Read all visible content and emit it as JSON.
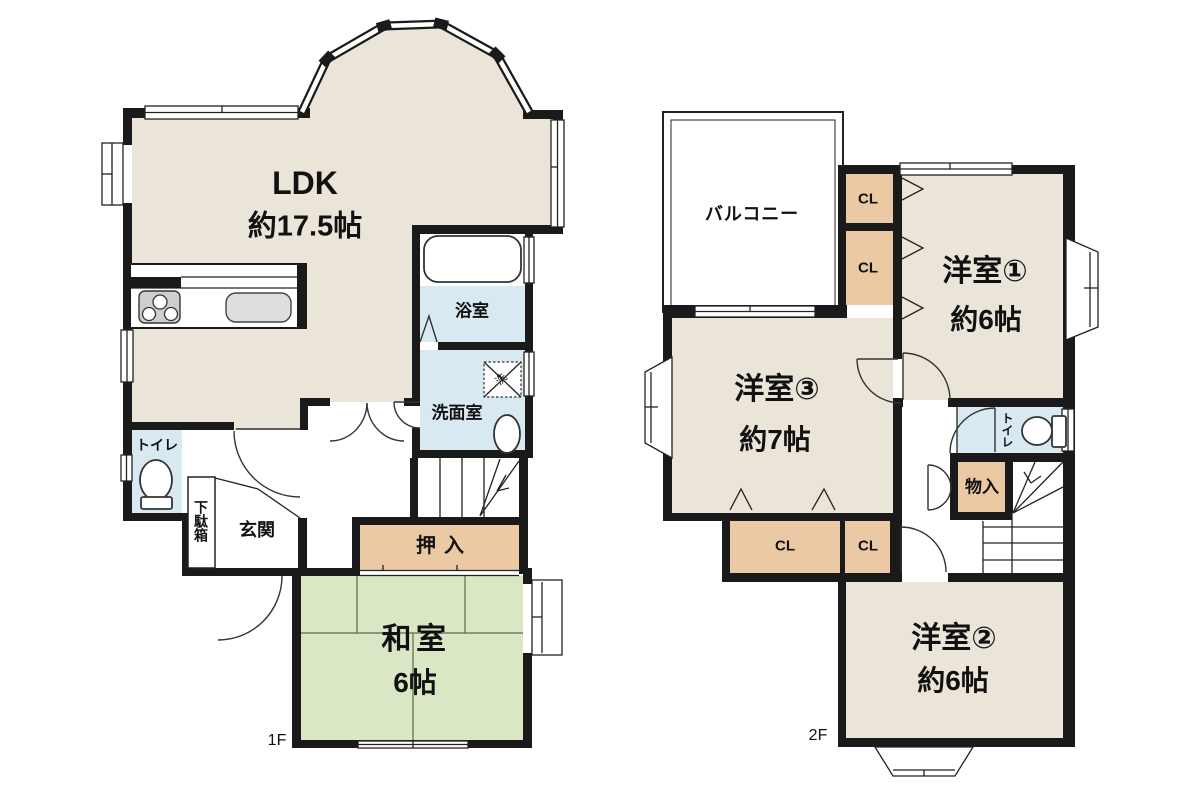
{
  "colors": {
    "wall": "#1a1a1a",
    "floor_beige": "#eae5d8",
    "tatami_green": "#d9e7c5",
    "closet_tan": "#ebc9a4",
    "water_blue": "#d9e9f2",
    "stove_gray": "#cfcfcf",
    "sink_gray": "#dedede"
  },
  "floor1": {
    "label": "1F",
    "rooms": {
      "ldk": {
        "name": "LDK",
        "size": "約17.5帖"
      },
      "washitsu": {
        "name": "和室",
        "size": "6帖"
      },
      "bath": "浴室",
      "washroom": "洗面室",
      "toilet": "トイレ",
      "genkan": "玄関",
      "getabako": "下駄箱",
      "oshiire": "押入",
      "laundry_mark": "洗"
    }
  },
  "floor2": {
    "label": "2F",
    "rooms": {
      "yoshitsu1": {
        "name": "洋室①",
        "size": "約6帖"
      },
      "yoshitsu2": {
        "name": "洋室②",
        "size": "約6帖"
      },
      "yoshitsu3": {
        "name": "洋室③",
        "size": "約7帖"
      },
      "balcony": "バルコニー",
      "toilet": "トイレ",
      "monoire": "物入",
      "cl_a": "CL",
      "cl_b": "CL",
      "cl_c": "CL",
      "cl_d": "CL"
    }
  }
}
